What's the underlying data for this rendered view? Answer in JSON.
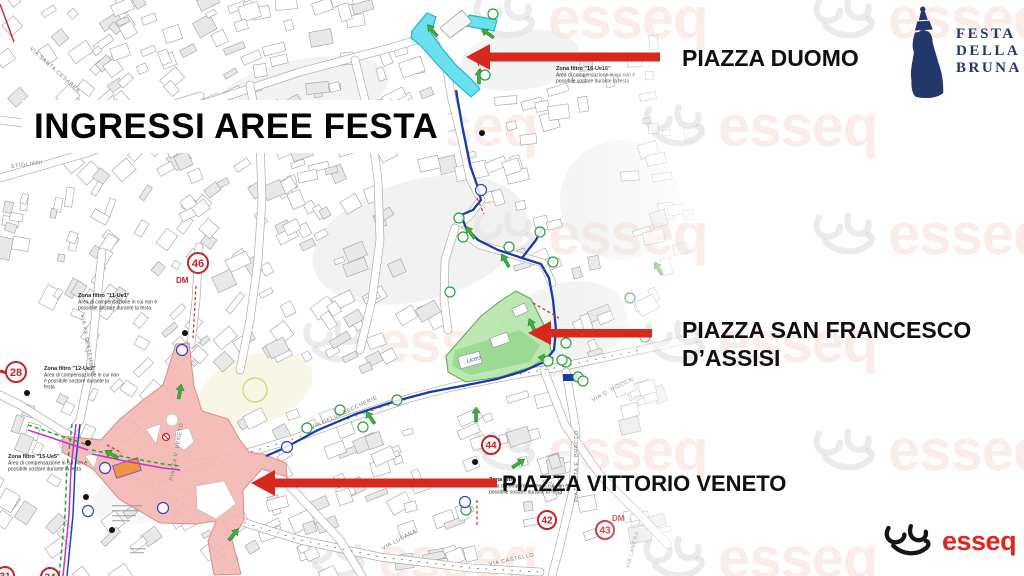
{
  "page": {
    "title_banner": "INGRESSI AREE FESTA"
  },
  "callouts": {
    "duomo": "PIAZZA DUOMO",
    "san_francesco_line1": "PIAZZA SAN FRANCESCO",
    "san_francesco_line2": "D’ASSISI",
    "vittorio_veneto": "PIAZZA VITTORIO VENETO"
  },
  "brand": {
    "festa_logo_lines": [
      "FESTA",
      "DELLA",
      "BRUNA"
    ],
    "festa_navy": "#24376b",
    "esseq_text": "esseq",
    "esseq_red": "#e2261d",
    "watermark_text": "esseq"
  },
  "map": {
    "arrow_color": "#d7281d",
    "zone_colors": {
      "piazza_duomo_fill": "#5edeee",
      "piazza_duomo_stroke": "#21b5cf",
      "san_francesco_fill": "#b7e5ab",
      "san_francesco_stroke": "#57a84e",
      "vittorio_veneto_fill": "#f4b6b3",
      "vittorio_veneto_stroke": "#d98c8c"
    },
    "numbered_markers": [
      {
        "label": "46",
        "x": 198,
        "y": 263,
        "r": 10
      },
      {
        "label": "28",
        "x": 16,
        "y": 372,
        "r": 10
      },
      {
        "label": "44",
        "x": 491,
        "y": 445,
        "r": 9
      },
      {
        "label": "42",
        "x": 547,
        "y": 520,
        "r": 9
      },
      {
        "label": "43",
        "x": 605,
        "y": 530,
        "r": 9
      },
      {
        "label": "31",
        "x": 5,
        "y": 576,
        "r": 9
      },
      {
        "label": "34",
        "x": 50,
        "y": 577,
        "r": 9
      }
    ],
    "dm_labels": [
      {
        "text": "DM",
        "x": 176,
        "y": 283
      },
      {
        "text": "DM",
        "x": 612,
        "y": 521
      }
    ],
    "filter_notes": [
      {
        "title": "Zona filtro \"16-Ue16\"",
        "lines": [
          "Area di compensazione in cui non è",
          "possibile sostare durante la festa"
        ],
        "x": 556,
        "y": 70
      },
      {
        "title": "Zona filtro \"11-Ue1\"",
        "lines": [
          "Area di compensazione in cui non è",
          "possibile sostare durante la festa"
        ],
        "x": 78,
        "y": 297
      },
      {
        "title": "Zona filtro \"12-Ue2\"",
        "lines": [
          "Area di compensazione in cui non",
          "è possibile sostare durante la",
          "festa"
        ],
        "x": 44,
        "y": 370
      },
      {
        "title": "Zona filtro \"15-Ue5\"",
        "lines": [
          "Area di compensazione in cui non è",
          "possibile sostare durante la festa"
        ],
        "x": 8,
        "y": 458
      },
      {
        "title": "Zona filtro",
        "lines": [
          "Area di compensazione in cui non è",
          "possibile sostare durante la festa"
        ],
        "x": 489,
        "y": 481
      }
    ],
    "street_names": [
      {
        "text": "VIA SANTA CESAREA",
        "x": 54,
        "y": 71,
        "rot": 42
      },
      {
        "text": "STIGLIANI",
        "x": 27,
        "y": 166,
        "rot": -8
      },
      {
        "text": "VIA XX SETTEMBRE",
        "x": 86,
        "y": 345,
        "rot": 80
      },
      {
        "text": "PIAZZA V. VENETO",
        "x": 178,
        "y": 452,
        "rot": -80
      },
      {
        "text": "VIA DELLE BECCHERIE",
        "x": 345,
        "y": 414,
        "rot": -25
      },
      {
        "text": "VIA D. RIDOLA",
        "x": 613,
        "y": 391,
        "rot": -28
      },
      {
        "text": "PIAZZETTA E. BRACCO",
        "x": 578,
        "y": 466,
        "rot": -90
      },
      {
        "text": "VIA LUCANA",
        "x": 400,
        "y": 541,
        "rot": -28
      },
      {
        "text": "VIA CASTELLO",
        "x": 512,
        "y": 561,
        "rot": -12
      },
      {
        "text": "VIA LANERA",
        "x": 634,
        "y": 550,
        "rot": -75
      }
    ],
    "poi_labels": [
      {
        "text": "Liceo",
        "x": 474,
        "y": 361,
        "rot": -15
      }
    ]
  }
}
